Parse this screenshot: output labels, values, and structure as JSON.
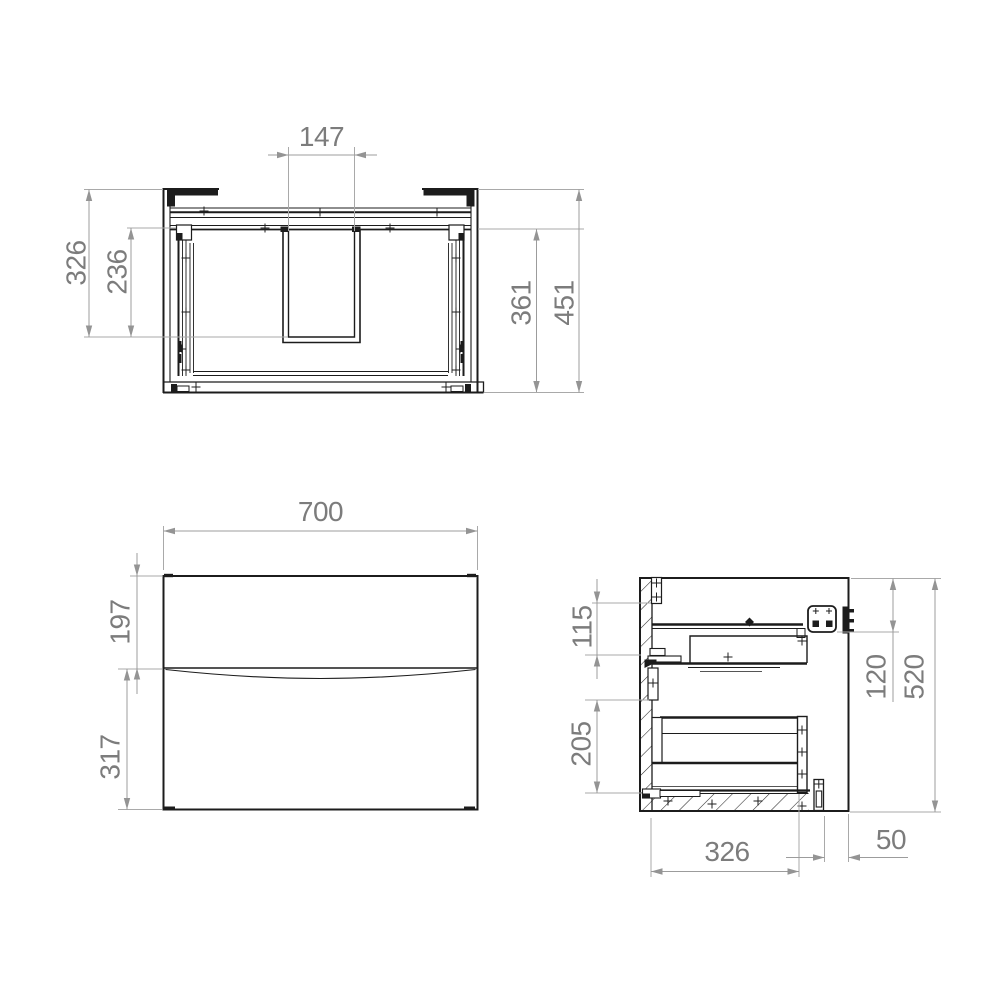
{
  "drawing": {
    "background": "#ffffff",
    "line_color": "#1c1c1c",
    "dimension_line_color": "#a9a9a9",
    "dimension_text_color": "#7c7c7c"
  },
  "dimensions": {
    "top_view": {
      "cutout_width": "147",
      "outer_depth": "326",
      "inner_depth": "236",
      "inner_depth_right": "361",
      "overall_depth": "451"
    },
    "front_view": {
      "overall_width": "700",
      "top_drawer_height": "197",
      "bottom_drawer_height": "317"
    },
    "side_view": {
      "top_drawer_side_height": "115",
      "bottom_drawer_side_height": "205",
      "bracket_offset": "120",
      "overall_height": "520",
      "drawer_depth": "326",
      "rear_clearance": "50"
    }
  }
}
